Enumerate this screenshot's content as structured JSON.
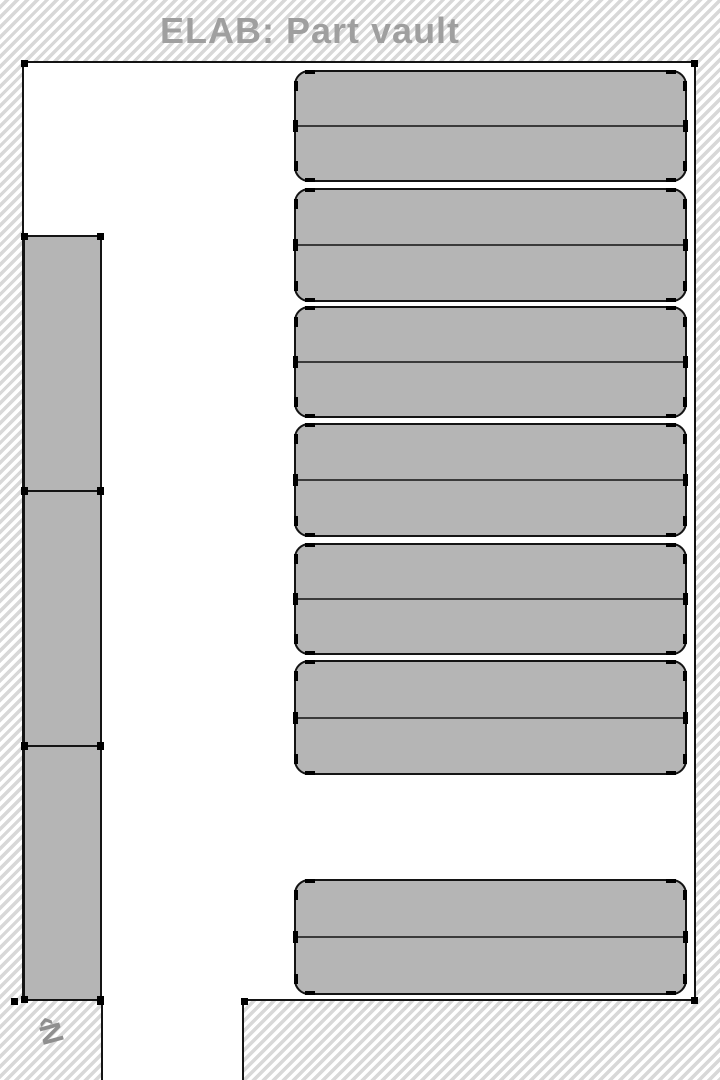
{
  "header": {
    "title": "ELAB: Part vault"
  },
  "compass": {
    "label": "‹N"
  },
  "colors": {
    "wall_hatch_stripe": "#d8d8d8",
    "floor": "#ffffff",
    "shape_fill": "#b5b5b5",
    "outline": "#141414",
    "divider": "#3a3a3a",
    "title_text": "#9f9f9f",
    "compass_text": "#8f8f8f"
  },
  "floorplan": {
    "floor_area": {
      "x": 22,
      "y": 61,
      "width": 674,
      "height": 940
    },
    "doorway_opening": {
      "x": 101,
      "y": 999,
      "width": 143,
      "height": 81
    },
    "racks_right": [
      {
        "label": "storage-rack-1",
        "top": 70,
        "height": 112
      },
      {
        "label": "storage-rack-2",
        "top": 188,
        "height": 114
      },
      {
        "label": "storage-rack-3",
        "top": 306,
        "height": 112
      },
      {
        "label": "storage-rack-4",
        "top": 423,
        "height": 114
      },
      {
        "label": "storage-rack-5",
        "top": 543,
        "height": 112
      },
      {
        "label": "storage-rack-6",
        "top": 660,
        "height": 115
      },
      {
        "label": "storage-rack-7",
        "top": 879,
        "height": 116
      }
    ],
    "wall_units_left": [
      {
        "label": "wall-unit-1",
        "top": 235,
        "height": 257
      },
      {
        "label": "wall-unit-2",
        "top": 490,
        "height": 257
      },
      {
        "label": "wall-unit-3",
        "top": 745,
        "height": 256
      }
    ],
    "corner_handles": [
      {
        "x": 24,
        "y": 63
      },
      {
        "x": 694,
        "y": 63
      },
      {
        "x": 694,
        "y": 1000
      },
      {
        "x": 14,
        "y": 1001
      },
      {
        "x": 100,
        "y": 1001
      },
      {
        "x": 244,
        "y": 1001
      }
    ]
  }
}
